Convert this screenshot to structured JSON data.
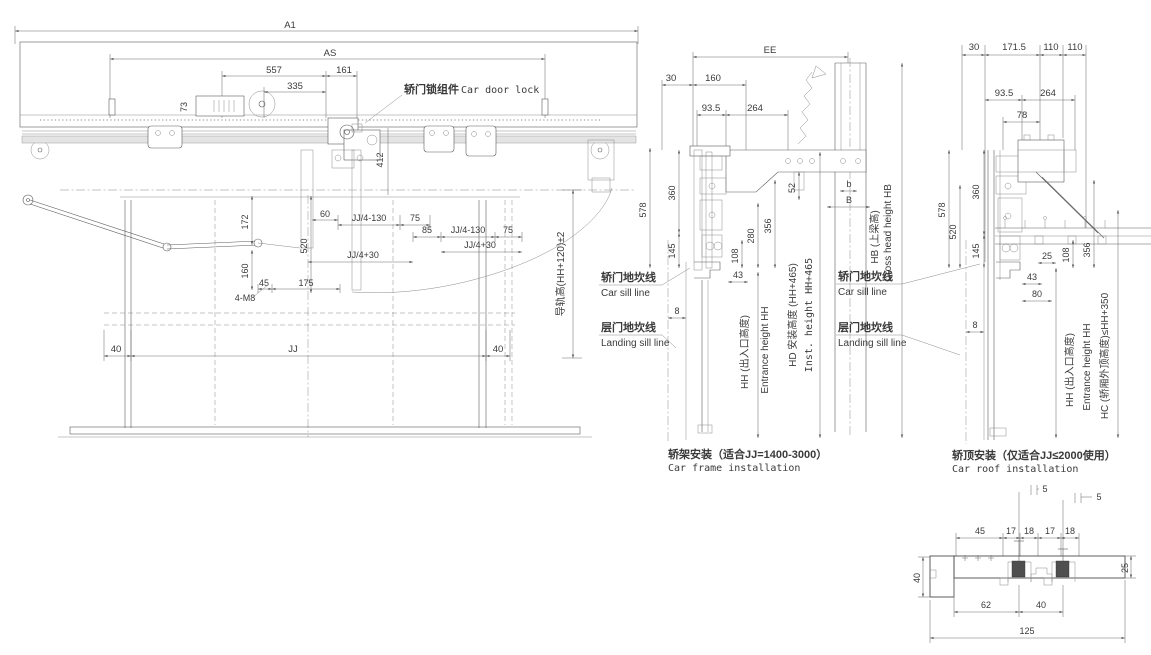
{
  "meta": {
    "background": "#ffffff",
    "line_color": "#4d4d4d",
    "accent_dark": "#4f4f4f"
  },
  "front_view": {
    "dims": {
      "a1": "A1",
      "as": "AS",
      "d557": "557",
      "d161": "161",
      "d335": "335",
      "d73": "73",
      "d412": "412",
      "d172": "172",
      "d520": "520",
      "d160": "160",
      "d60": "60",
      "jj4m130_a": "JJ/4-130",
      "d75_a": "75",
      "d85": "85",
      "jj4m130_b": "JJ/4-130",
      "d75_b": "75",
      "jj4p30_a": "JJ/4+30",
      "jj4p30_b": "JJ/4+30",
      "d45": "45",
      "d175": "175",
      "m8": "4-M8",
      "d40_left": "40",
      "jj": "JJ",
      "d40_right": "40",
      "rail_height": "导轨高(HH+120)±2"
    },
    "labels": {
      "lock_cn": "轿门锁组件",
      "lock_en": "Car door lock"
    }
  },
  "car_frame_view": {
    "caption_cn": "轿架安装（适合JJ=1400-3000）",
    "caption_en": "Car frame installation",
    "dims": {
      "ee": "EE",
      "d30": "30",
      "d160": "160",
      "d93_5": "93.5",
      "d264": "264",
      "d578": "578",
      "d360": "360",
      "d145": "145",
      "d52": "52",
      "b_small": "b",
      "b_cap": "B",
      "d280": "280",
      "d356": "356",
      "d108": "108",
      "d43": "43",
      "d8": "8"
    },
    "axis_labels": {
      "hh_cn": "HH (出入口高度)",
      "hh_en": "Entrance height HH",
      "hd_cn": "HD 安装高度 (HH+465)",
      "hd_en": "Inst. height HH+465",
      "hb_cn": "HB (上梁高)",
      "hb_en": "Cross head height HB"
    },
    "sill_labels": {
      "car_cn": "轿门地坎线",
      "car_en": "Car sill line",
      "landing_cn": "层门地坎线",
      "landing_en": "Landing sill line"
    }
  },
  "car_roof_view": {
    "caption_cn": "轿顶安装（仅适合JJ≤2000使用）",
    "caption_en": "Car roof installation",
    "dims": {
      "d30": "30",
      "d171_5": "171.5",
      "d110_a": "110",
      "d110_b": "110",
      "d93_5": "93.5",
      "d264": "264",
      "d78": "78",
      "d578": "578",
      "d520": "520",
      "d360": "360",
      "d145": "145",
      "d25": "25",
      "d108": "108",
      "d356": "356",
      "d43": "43",
      "d80": "80",
      "d8": "8"
    },
    "axis_labels": {
      "hh_cn": "HH (出入口高度)",
      "hh_en": "Entrance height HH",
      "hc": "HC (轿厢外顶高度)≤HH+350"
    },
    "sill_labels": {
      "car_cn": "轿门地坎线",
      "car_en": "Car sill line",
      "landing_cn": "层门地坎线",
      "landing_en": "Landing sill line"
    }
  },
  "sill_section_view": {
    "dims": {
      "d5_a": "5",
      "d5_b": "5",
      "d45": "45",
      "d17_a": "17",
      "d18_a": "18",
      "d17_b": "17",
      "d18_b": "18",
      "d25": "25",
      "d40_height": "40",
      "d62": "62",
      "d40": "40",
      "d125": "125"
    }
  }
}
